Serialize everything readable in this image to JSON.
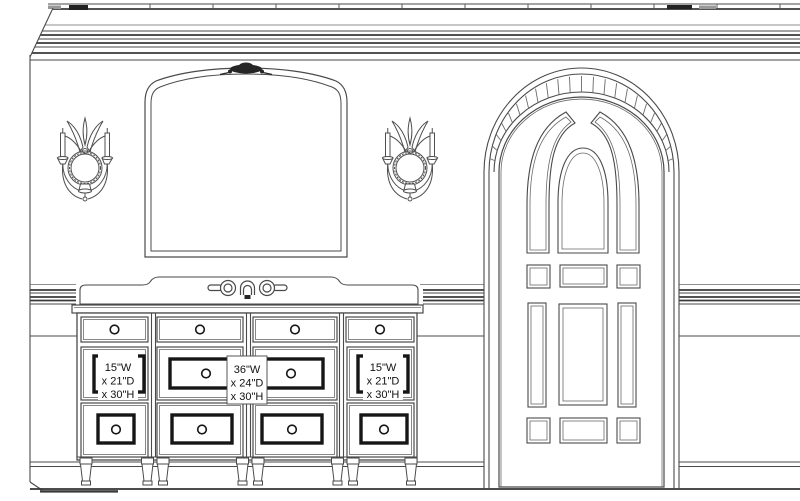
{
  "drawing": {
    "colors": {
      "background": "#ffffff",
      "line": "#4a4a4a",
      "dark_accent": "#1a1a1a"
    },
    "vanity_labels": {
      "left": {
        "line1": "15\"W",
        "line2": "x 21\"D",
        "line3": "x 30\"H"
      },
      "center": {
        "line1": "36\"W",
        "line2": "x 24\"D",
        "line3": "x 30\"H"
      },
      "right": {
        "line1": "15\"W",
        "line2": "x 21\"D",
        "line3": "x 30\"H"
      }
    }
  }
}
